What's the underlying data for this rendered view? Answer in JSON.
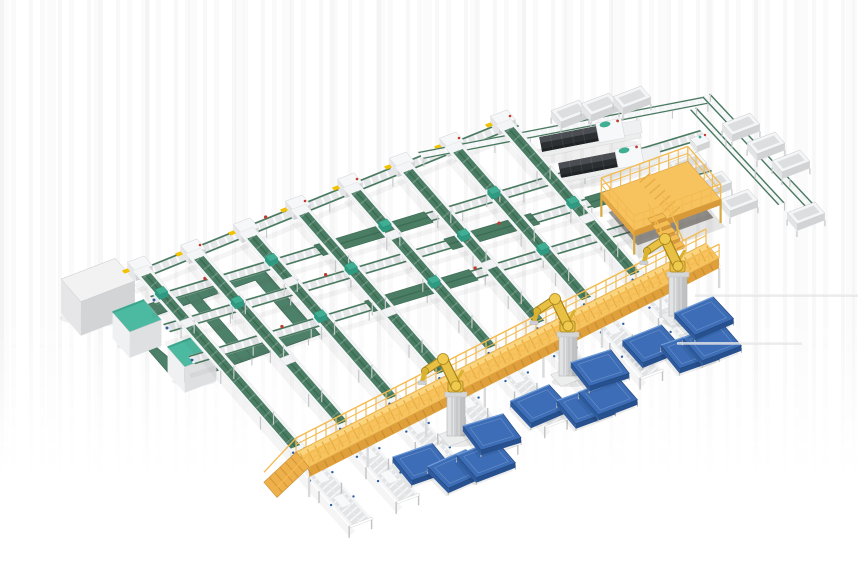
{
  "scene": {
    "canvas": {
      "w": 860,
      "h": 580
    },
    "palette": {
      "bg": "#ffffff",
      "belt_green": "#4a7d64",
      "belt_green_dark": "#3a6b53",
      "belt_green_edge": "#47795f",
      "flat_green": "#4d8069",
      "flat_green_dark": "#3f6d58",
      "rail_base": "#e6e7e9",
      "rail_white": "#f4f5f6",
      "rail_tick": "#fafbfc",
      "stub_inner": "#e2e4e6",
      "frame_leg": "#c7c9cb",
      "walkway_top": "#f7c35f",
      "walkway_light": "#fbd47e",
      "walkway_front": "#dfa03c",
      "walkway_rail": "#f3bb51",
      "walkway_dark": "#c98c30",
      "robot_yellow": "#e8c043",
      "robot_outline": "#a9861d",
      "robot_dark": "#d9b22f",
      "pedestal_light": "#e2e3e5",
      "pedestal_mid": "#cfd1d3",
      "pedestal_dark": "#bfc1c3",
      "panel_top": "#3c6db6",
      "panel_front": "#27508f",
      "panel_side": "#2f5c9f",
      "panel_hi": "#6f9bd6",
      "panel_line": "#24497f",
      "machine_top": "#4a4e52",
      "machine_body": "#2c2f32",
      "machine_end": "#202325",
      "machine_white": "#f7f8f9",
      "teal": "#3fae92",
      "teal_dark": "#2f9a82",
      "cab_top": "#f2f2f3",
      "cab_left": "#e6e6e8",
      "cab_right": "#d3d4d6",
      "cab_teal_top": "#4cbaa0",
      "cab_teal_side": "#3ba78d",
      "red": "#c23b2e",
      "yellow": "#f2c200",
      "blue_mark": "#2e5fa3",
      "faint": "#e3e3e3"
    },
    "angles": {
      "main": -21,
      "spur": 49
    },
    "head_line": {
      "from": [
        133,
        272
      ],
      "to": [
        512,
        118
      ],
      "width": 11
    },
    "heads": [
      [
        140,
        268
      ],
      [
        193,
        251
      ],
      [
        246,
        230
      ],
      [
        298,
        207
      ],
      [
        350,
        185
      ],
      [
        402,
        164
      ],
      [
        452,
        144
      ],
      [
        503,
        122
      ]
    ],
    "main_lines": [
      {
        "from": [
          150,
          296
        ],
        "to": [
          700,
          130
        ]
      },
      {
        "from": [
          163,
          324
        ],
        "to": [
          705,
          163
        ]
      },
      {
        "from": [
          188,
          356
        ],
        "to": [
          710,
          198
        ]
      }
    ],
    "line_width": 11,
    "green_patches": [
      [
        0,
        0.3,
        0.5
      ],
      [
        1,
        0.52,
        0.68
      ],
      [
        2,
        0.34,
        0.54
      ],
      [
        1,
        0.78,
        0.88
      ]
    ],
    "teal_pairs": [
      [
        0,
        0
      ],
      [
        1,
        1
      ],
      [
        2,
        0
      ],
      [
        2,
        2
      ],
      [
        3,
        1
      ],
      [
        4,
        0
      ],
      [
        4,
        2
      ],
      [
        5,
        1
      ],
      [
        6,
        0
      ],
      [
        6,
        2
      ],
      [
        7,
        1
      ]
    ],
    "red_dots": [
      [
        0,
        0.1
      ],
      [
        0,
        0.42
      ],
      [
        1,
        0.3
      ],
      [
        1,
        0.62
      ],
      [
        2,
        0.18
      ],
      [
        2,
        0.55
      ],
      [
        3,
        0.35
      ],
      [
        3,
        0.72
      ]
    ],
    "top_line": {
      "from": [
        418,
        152
      ],
      "to": [
        702,
        97
      ],
      "width": 9
    },
    "loop_line": {
      "from": [
        702,
        97
      ],
      "to": [
        808,
        210
      ],
      "width": 9
    },
    "loop_line2": {
      "from": [
        690,
        110
      ],
      "to": [
        778,
        205
      ],
      "width": 7
    },
    "junction": [
      700,
      140
    ],
    "walkway": {
      "from": [
        296,
        452
      ],
      "to": [
        706,
        243
      ],
      "width": 20,
      "height": 10
    },
    "stubs": {
      "start": 2,
      "length": 92,
      "width": 24
    },
    "robots": [
      [
        456,
        438
      ],
      [
        568,
        378
      ],
      [
        678,
        318
      ]
    ],
    "panels": {
      "L": 42,
      "W": 30,
      "items": [
        [
          422,
          462,
          2
        ],
        [
          457,
          469,
          -3
        ],
        [
          486,
          459,
          0
        ],
        [
          492,
          432,
          4
        ],
        [
          540,
          404,
          -2
        ],
        [
          586,
          405,
          1
        ],
        [
          608,
          396,
          0
        ],
        [
          600,
          368,
          3
        ],
        [
          652,
          344,
          -1
        ],
        [
          690,
          350,
          2
        ],
        [
          712,
          342,
          0
        ],
        [
          704,
          316,
          -2
        ]
      ]
    },
    "machines": [
      {
        "c": [
          582,
          137
        ]
      },
      {
        "c": [
          601,
          163
        ]
      }
    ],
    "platform": {
      "c": [
        661,
        196
      ],
      "len": 92,
      "wid": 50
    },
    "cabinet_big": {
      "c": [
        98,
        280
      ],
      "len": 58,
      "wid": 30,
      "h": 34
    },
    "cabinets_small": [
      [
        137,
        316
      ],
      [
        192,
        351
      ]
    ],
    "ring": {
      "corner": [
        118,
        315
      ],
      "len": 150,
      "wid": 92,
      "band": 14,
      "angle": -19.5
    },
    "trays": [
      [
        570,
        111
      ],
      [
        600,
        104
      ],
      [
        632,
        97
      ],
      [
        741,
        124
      ],
      [
        766,
        143
      ],
      [
        791,
        161
      ],
      [
        688,
        163
      ],
      [
        713,
        182
      ],
      [
        739,
        200
      ],
      [
        806,
        213
      ]
    ],
    "faint_lines": [
      [
        695,
        296,
        858,
        296
      ],
      [
        677,
        344,
        802,
        344
      ]
    ],
    "inventory": {
      "incline_belt_conveyors": 8,
      "main_conveyor_lines": 5,
      "robot_arms": 3,
      "blue_pallet_panels": 12,
      "tray_stations": 10,
      "processing_machines": 2,
      "operator_platforms": 1,
      "control_cabinets": 3,
      "floor_belt_loops": 1,
      "overhead_walkways": 1
    }
  }
}
